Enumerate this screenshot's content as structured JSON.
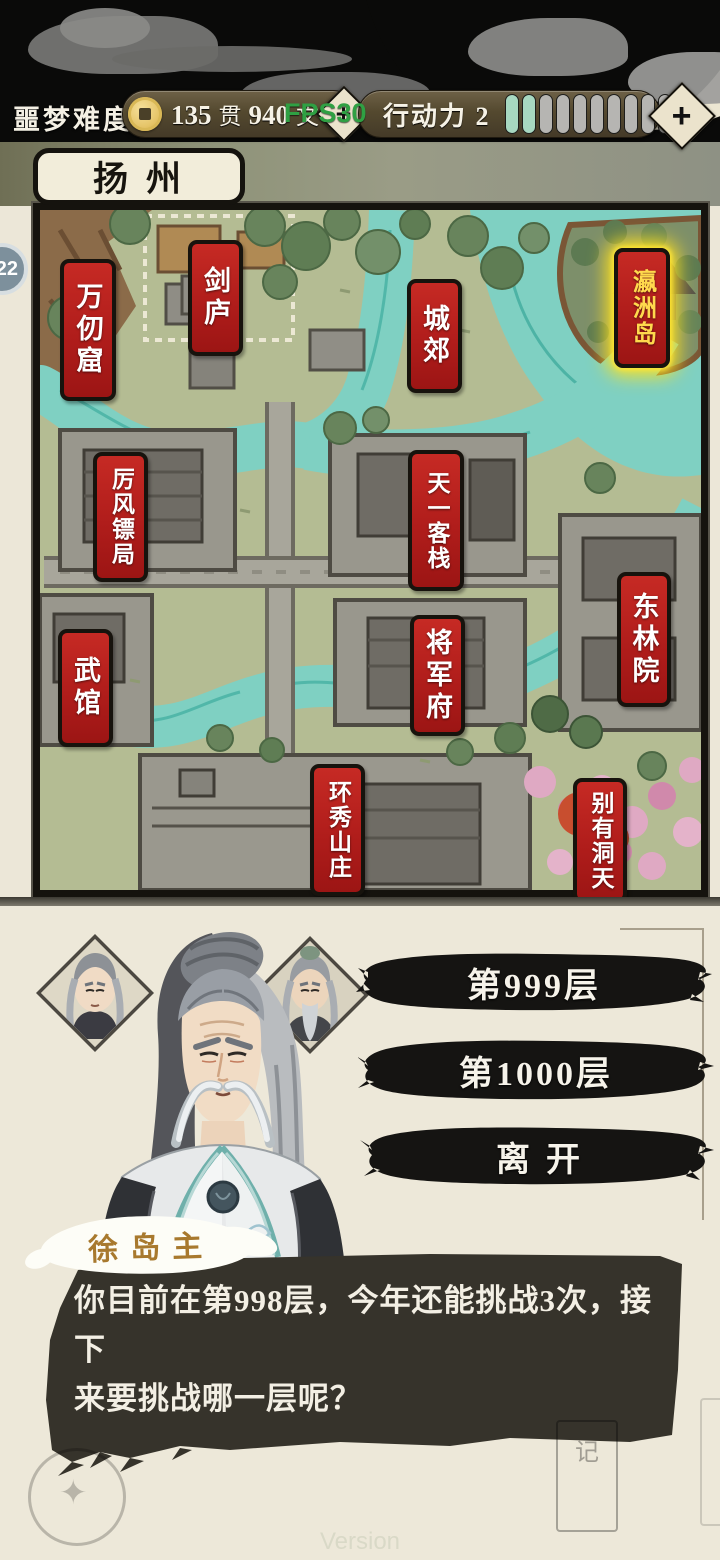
{
  "status_bar": {
    "difficulty": "噩梦难度",
    "currency": {
      "guan_value": "135",
      "guan_unit": "贯",
      "wen_value": "940",
      "wen_unit": "文"
    },
    "currency_add": "+",
    "fps_overlay": "FPS30",
    "action_label": "行动力 2",
    "action_segments": {
      "total": 10,
      "active": 2
    },
    "action_add": "+"
  },
  "map": {
    "region_title": "扬州",
    "level_badge": "22",
    "locations": [
      {
        "name": "万仞窟",
        "highlighted": false
      },
      {
        "name": "剑庐",
        "highlighted": false
      },
      {
        "name": "城郊",
        "highlighted": false
      },
      {
        "name": "瀛洲岛",
        "highlighted": true
      },
      {
        "name": "厉风镖局",
        "highlighted": false
      },
      {
        "name": "天一客栈",
        "highlighted": false
      },
      {
        "name": "东林院",
        "highlighted": false
      },
      {
        "name": "武馆",
        "highlighted": false
      },
      {
        "name": "将军府",
        "highlighted": false
      },
      {
        "name": "环秀山庄",
        "highlighted": false
      },
      {
        "name": "别有洞天",
        "highlighted": false
      }
    ]
  },
  "dialog": {
    "speaker": "徐岛主",
    "line1": "你目前在第998层，今年还能挑战3次，接下",
    "line2": "来要挑战哪一层呢？",
    "options": [
      {
        "label": "第999层"
      },
      {
        "label": "第1000层"
      },
      {
        "label": "离开"
      }
    ],
    "decor_tablet_char": "记"
  },
  "footer": {
    "version_watermark": "Version"
  },
  "colors": {
    "banner_red": "#b01d1b",
    "highlight_gold": "#ffd94d",
    "glow_yellow": "#ffe21e",
    "action_active": "#a7d8c1",
    "fps_green": "#2fa043",
    "dialog_bg": "#36332b",
    "ink_black": "#151412",
    "cream": "#ece7d8"
  }
}
